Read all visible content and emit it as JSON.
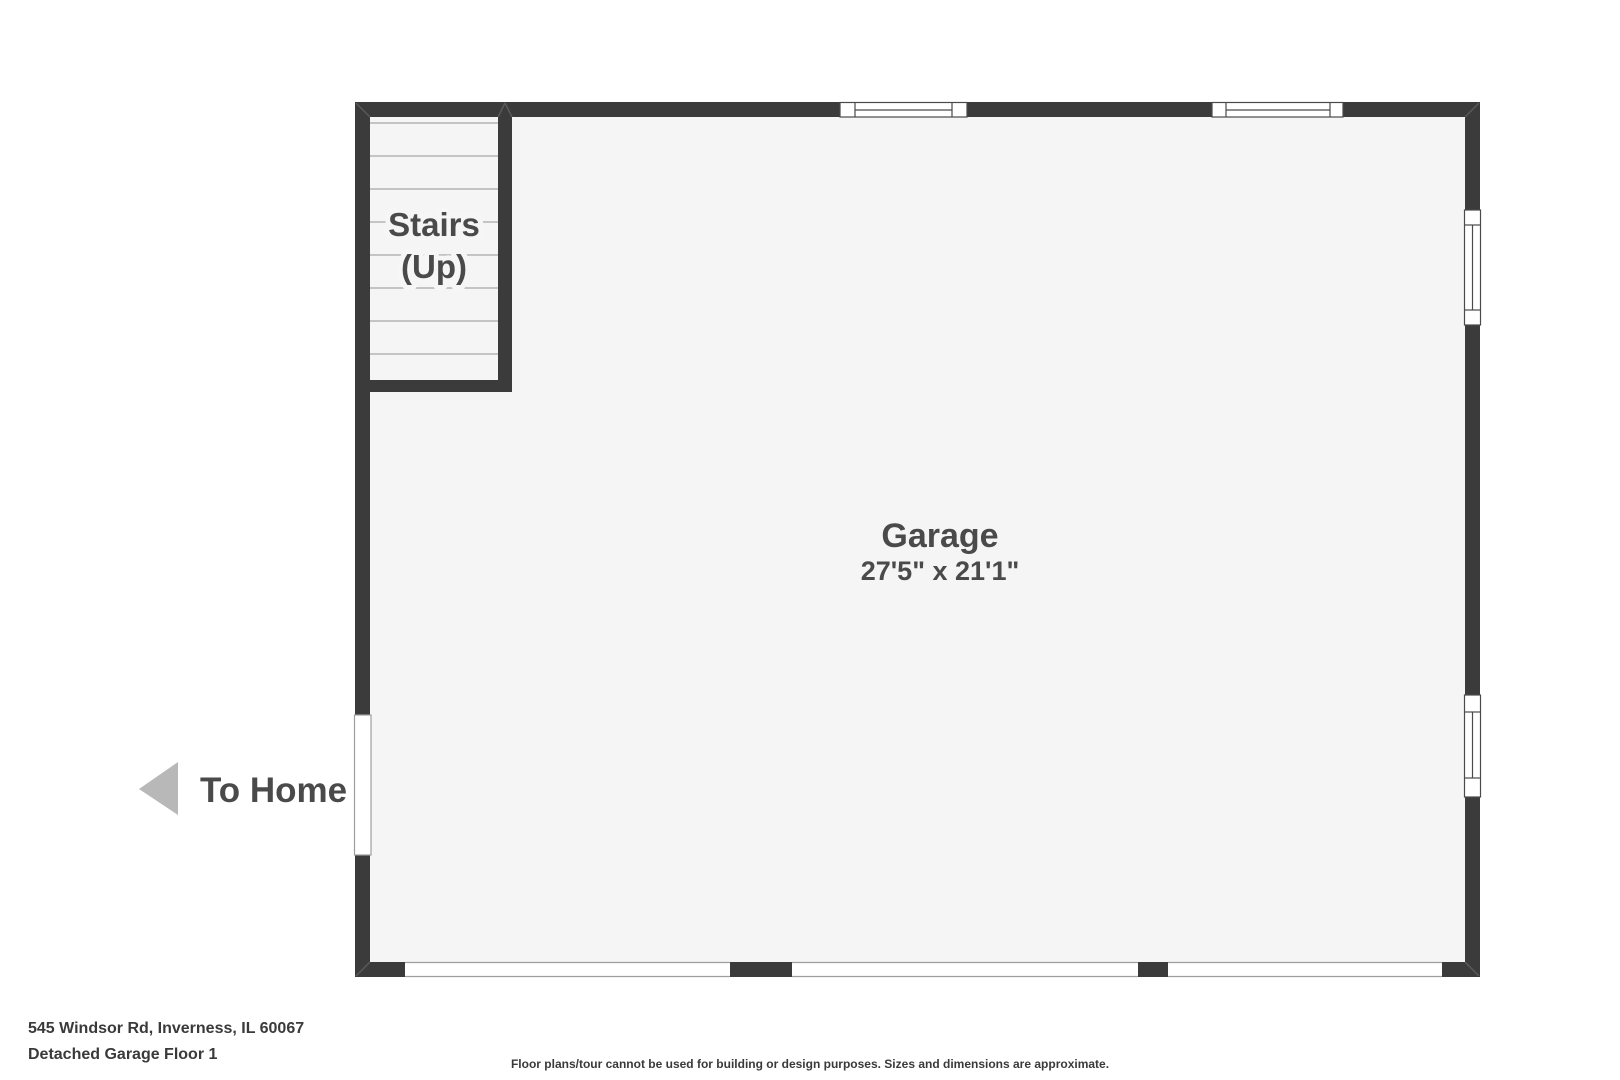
{
  "plan": {
    "stairs": {
      "line1": "Stairs",
      "line2": "(Up)"
    },
    "room": {
      "name": "Garage",
      "dimensions": "27'5\" x 21'1\""
    },
    "exit": {
      "label": "To Home"
    }
  },
  "footer": {
    "address": "545 Windsor Rd, Inverness, IL 60067",
    "floor_label": "Detached Garage Floor 1",
    "disclaimer": "Floor plans/tour cannot be used for building or design purposes. Sizes and dimensions are approximate."
  },
  "colors": {
    "wall": "#3b3b3b",
    "floor": "#f5f5f5",
    "text": "#4a4a4a",
    "footer_text": "#3a3a3a",
    "arrow": "#b8b8b8"
  }
}
